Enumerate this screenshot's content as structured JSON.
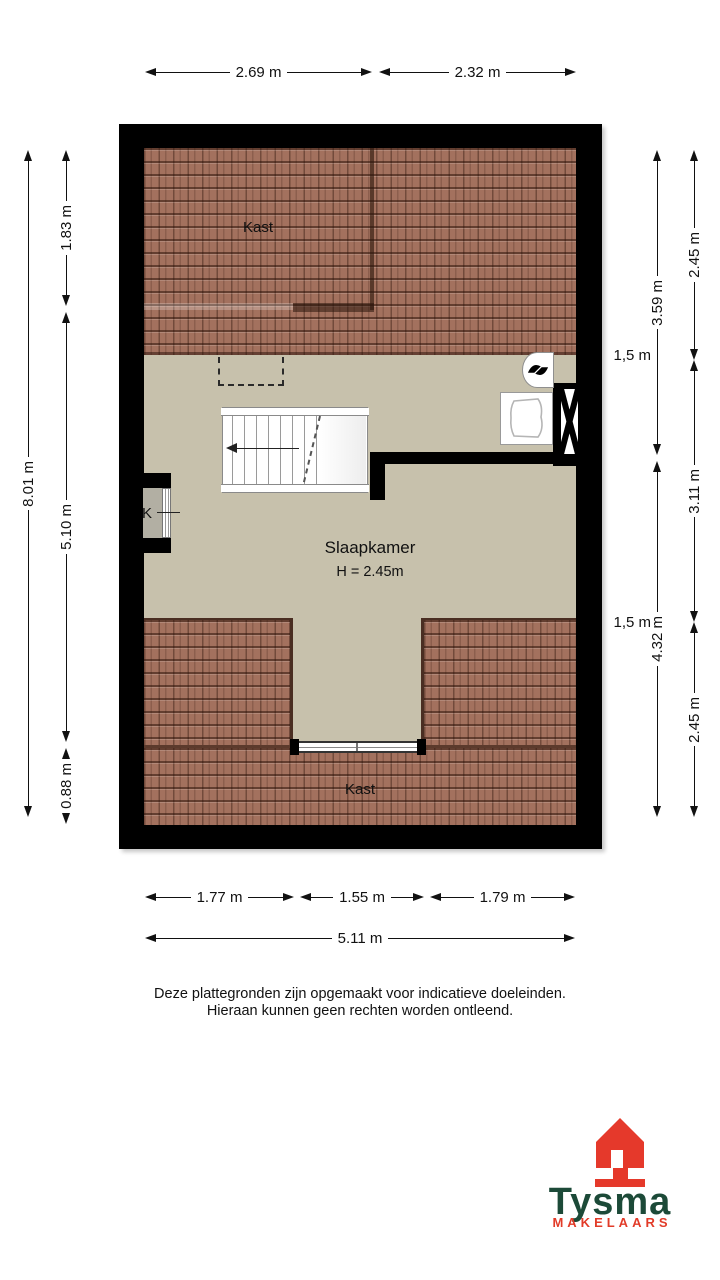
{
  "floorplan": {
    "rooms": {
      "kast_top": "Kast",
      "kast_bottom": "Kast",
      "slaapkamer": "Slaapkamer",
      "slaapkamer_height": "H = 2.45m",
      "closet_label": "K"
    }
  },
  "dimensions": [
    {
      "label": "2.69 m",
      "orient": "h",
      "x": 145,
      "y": 72,
      "len": 227
    },
    {
      "label": "2.32 m",
      "orient": "h",
      "x": 379,
      "y": 72,
      "len": 197
    },
    {
      "label": "8.01 m",
      "orient": "v",
      "x": 28,
      "y": 150,
      "len": 667
    },
    {
      "label": "1.83 m",
      "orient": "v",
      "x": 66,
      "y": 150,
      "len": 156
    },
    {
      "label": "5.10 m",
      "orient": "v",
      "x": 66,
      "y": 312,
      "len": 430
    },
    {
      "label": "0.88 m",
      "orient": "v",
      "x": 66,
      "y": 748,
      "len": 69
    },
    {
      "label": "3.59 m",
      "orient": "v",
      "x": 657,
      "y": 150,
      "len": 305
    },
    {
      "label": "4.32 m",
      "orient": "v",
      "x": 657,
      "y": 461,
      "len": 356
    },
    {
      "label": "2.45 m",
      "orient": "v",
      "x": 694,
      "y": 150,
      "len": 210
    },
    {
      "label": "3.11 m",
      "orient": "v",
      "x": 694,
      "y": 360,
      "len": 262
    },
    {
      "label": "2.45 m",
      "orient": "v",
      "x": 694,
      "y": 622,
      "len": 195
    },
    {
      "label": "1.77 m",
      "orient": "h",
      "x": 145,
      "y": 897,
      "len": 149
    },
    {
      "label": "1.55 m",
      "orient": "h",
      "x": 300,
      "y": 897,
      "len": 124
    },
    {
      "label": "1.79 m",
      "orient": "h",
      "x": 430,
      "y": 897,
      "len": 145
    },
    {
      "label": "5.11 m",
      "orient": "h",
      "x": 145,
      "y": 938,
      "len": 430
    }
  ],
  "clearance_labels": [
    {
      "label": "1,5 m",
      "x": 581,
      "y": 347
    },
    {
      "label": "1,5 m",
      "x": 581,
      "y": 614
    }
  ],
  "disclaimer": {
    "line1": "Deze plattegronden zijn opgemaakt voor indicatieve doeleinden.",
    "line2": "Hieraan kunnen geen rechten worden ontleend."
  },
  "logo": {
    "brand": "Tysma",
    "tagline": "MAKELAARS"
  },
  "colors": {
    "floor": "#c7c1ac",
    "roof": "#a3715e",
    "wall": "#000000",
    "roof_line": "#4a2e22",
    "logo_green": "#1c4a38",
    "logo_red": "#e23b28"
  }
}
